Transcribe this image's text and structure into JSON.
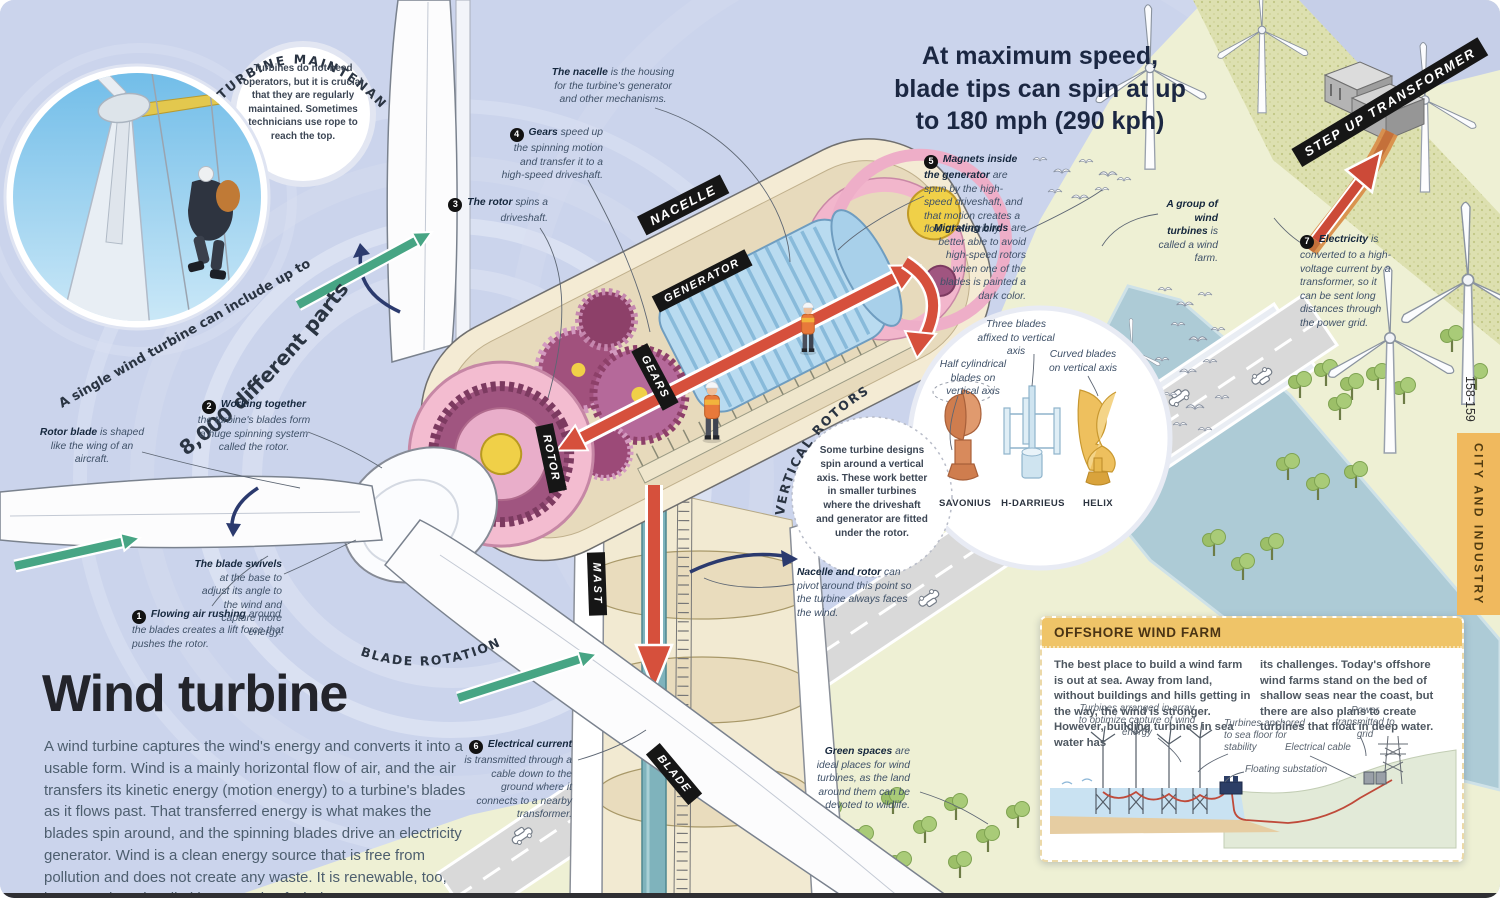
{
  "header": {
    "stat": "At maximum speed, blade tips can spin at up to 180 mph (290 kph)",
    "page_numbers": "158-159",
    "page_tab": "CITY AND INDUSTRY"
  },
  "title_block": {
    "title": "Wind turbine",
    "intro": "A wind turbine captures the wind's energy and converts it into a usable form. Wind is a mainly horizontal flow of air, and the air transfers its kinetic energy (motion energy) to a turbine's blades as it flows past. That transferred energy is what makes the blades spin around, and the spinning blades drive an electricity generator. Wind is a clean energy source that is free from pollution and does not create any waste. It is renewable, too, because there is a limitless supply of wind."
  },
  "arcs": {
    "turbine_maintenance": "TURBINE MAINTENANCE",
    "single_turbine_line1": "A single wind turbine can include up to",
    "single_turbine_line2": "8,000 different parts",
    "blade_rotation": "BLADE ROTATION",
    "vertical_rotors": "VERTICAL ROTORS"
  },
  "bubbles": {
    "maintenance": "Turbines do not need operators, but it is crucial that they are regularly maintained. Sometimes technicians use rope to reach the top.",
    "vertical_rotors": "Some turbine designs spin around a vertical axis. These work better in smaller turbines where the driveshaft and generator are fitted under the rotor."
  },
  "part_labels": {
    "nacelle": "NACELLE",
    "generator": "GENERATOR",
    "gears": "GEARS",
    "rotor": "ROTOR",
    "mast": "MAST",
    "blade": "BLADE",
    "transformer": "STEP UP TRANSFORMER"
  },
  "callouts": [
    {
      "num": "1",
      "lead": "Flowing air rushing",
      "rest": "around the blades creates a lift force that pushes the rotor."
    },
    {
      "num": "2",
      "lead": "Working together",
      "rest": "the turbine's blades form a huge spinning system called the rotor."
    },
    {
      "num": "3",
      "lead": "The rotor",
      "rest": "spins a driveshaft."
    },
    {
      "num": "4",
      "lead": "Gears",
      "rest": "speed up the spinning motion and transfer it to a high-speed driveshaft."
    },
    {
      "num": "5",
      "lead": "Magnets inside the generator",
      "rest": "are spun by the high-speed driveshaft, and that motion creates a flow of electricity."
    },
    {
      "num": "6",
      "lead": "Electrical current",
      "rest": "is transmitted through a cable down to the ground where it connects to a nearby transformer."
    },
    {
      "num": "7",
      "lead": "Electricity",
      "rest": "is converted to a high-voltage current by a transformer, so it can be sent long distances through the power grid."
    }
  ],
  "annotations": {
    "nacelle_housing": {
      "lead": "The nacelle",
      "rest": "is the housing for the turbine's generator and other mechanisms."
    },
    "migrating_birds": {
      "lead": "Migrating birds",
      "rest": "are better able to avoid high-speed rotors when one of the blades is painted a dark color."
    },
    "wind_farm_group": {
      "lead": "A group of wind turbines",
      "rest": "is called a wind farm."
    },
    "rotor_blade": {
      "lead": "Rotor blade",
      "rest": "is shaped like the wing of an aircraft."
    },
    "blade_swivels": {
      "lead": "The blade swivels",
      "rest": "at the base to adjust its angle to the wind and capture more energy."
    },
    "pivot": {
      "lead": "Nacelle and rotor",
      "rest": "can pivot around this point so the turbine always faces the wind."
    },
    "green_spaces": {
      "lead": "Green spaces",
      "rest": "are ideal places for wind turbines, as the land around them can be devoted to wildlife."
    }
  },
  "vertical_rotors": {
    "types": [
      {
        "caption": "Half cylindrical blades on vertical axis",
        "name": "SAVONIUS"
      },
      {
        "caption": "Three blades affixed to vertical axis",
        "name": "H-DARRIEUS"
      },
      {
        "caption": "Curved blades on vertical axis",
        "name": "HELIX"
      }
    ]
  },
  "offshore": {
    "heading": "OFFSHORE WIND FARM",
    "col1": "The best place to build a wind farm is out at sea. Away from land, without buildings and hills getting in the way, the wind is stronger. However, building turbines in sea water has",
    "col2": "its challenges. Today's offshore wind farms stand on the bed of shallow seas near the coast, but there are also plans to create turbines that float in deep water.",
    "labels": {
      "arranged": "Turbines arranged in array to optimize capture of wind energy",
      "anchored": "Turbines anchored to sea floor for stability",
      "power": "Power transmitted to grid",
      "cable": "Electrical cable",
      "substation": "Floating substation"
    }
  },
  "colors": {
    "page_bg": "#cbd4ec",
    "land": "#eef0d4",
    "river": "#adcbd6",
    "road": "#d9d9d9",
    "nacelle_cream": "#f4ebd4",
    "rotor_pink": "#f3bcd0",
    "gears_purple": "#a1517d",
    "generator_blue": "#b9dbf0",
    "shaft_yellow": "#f0d048",
    "driveshaft_teal": "#7fb3bc",
    "arrow_red": "#d6503c",
    "arrow_green": "#47a584",
    "arrow_navy": "#2b3a6e",
    "label_black": "#161616",
    "banner_orange": "#f0b95e",
    "offshore_header": "#efc468"
  }
}
